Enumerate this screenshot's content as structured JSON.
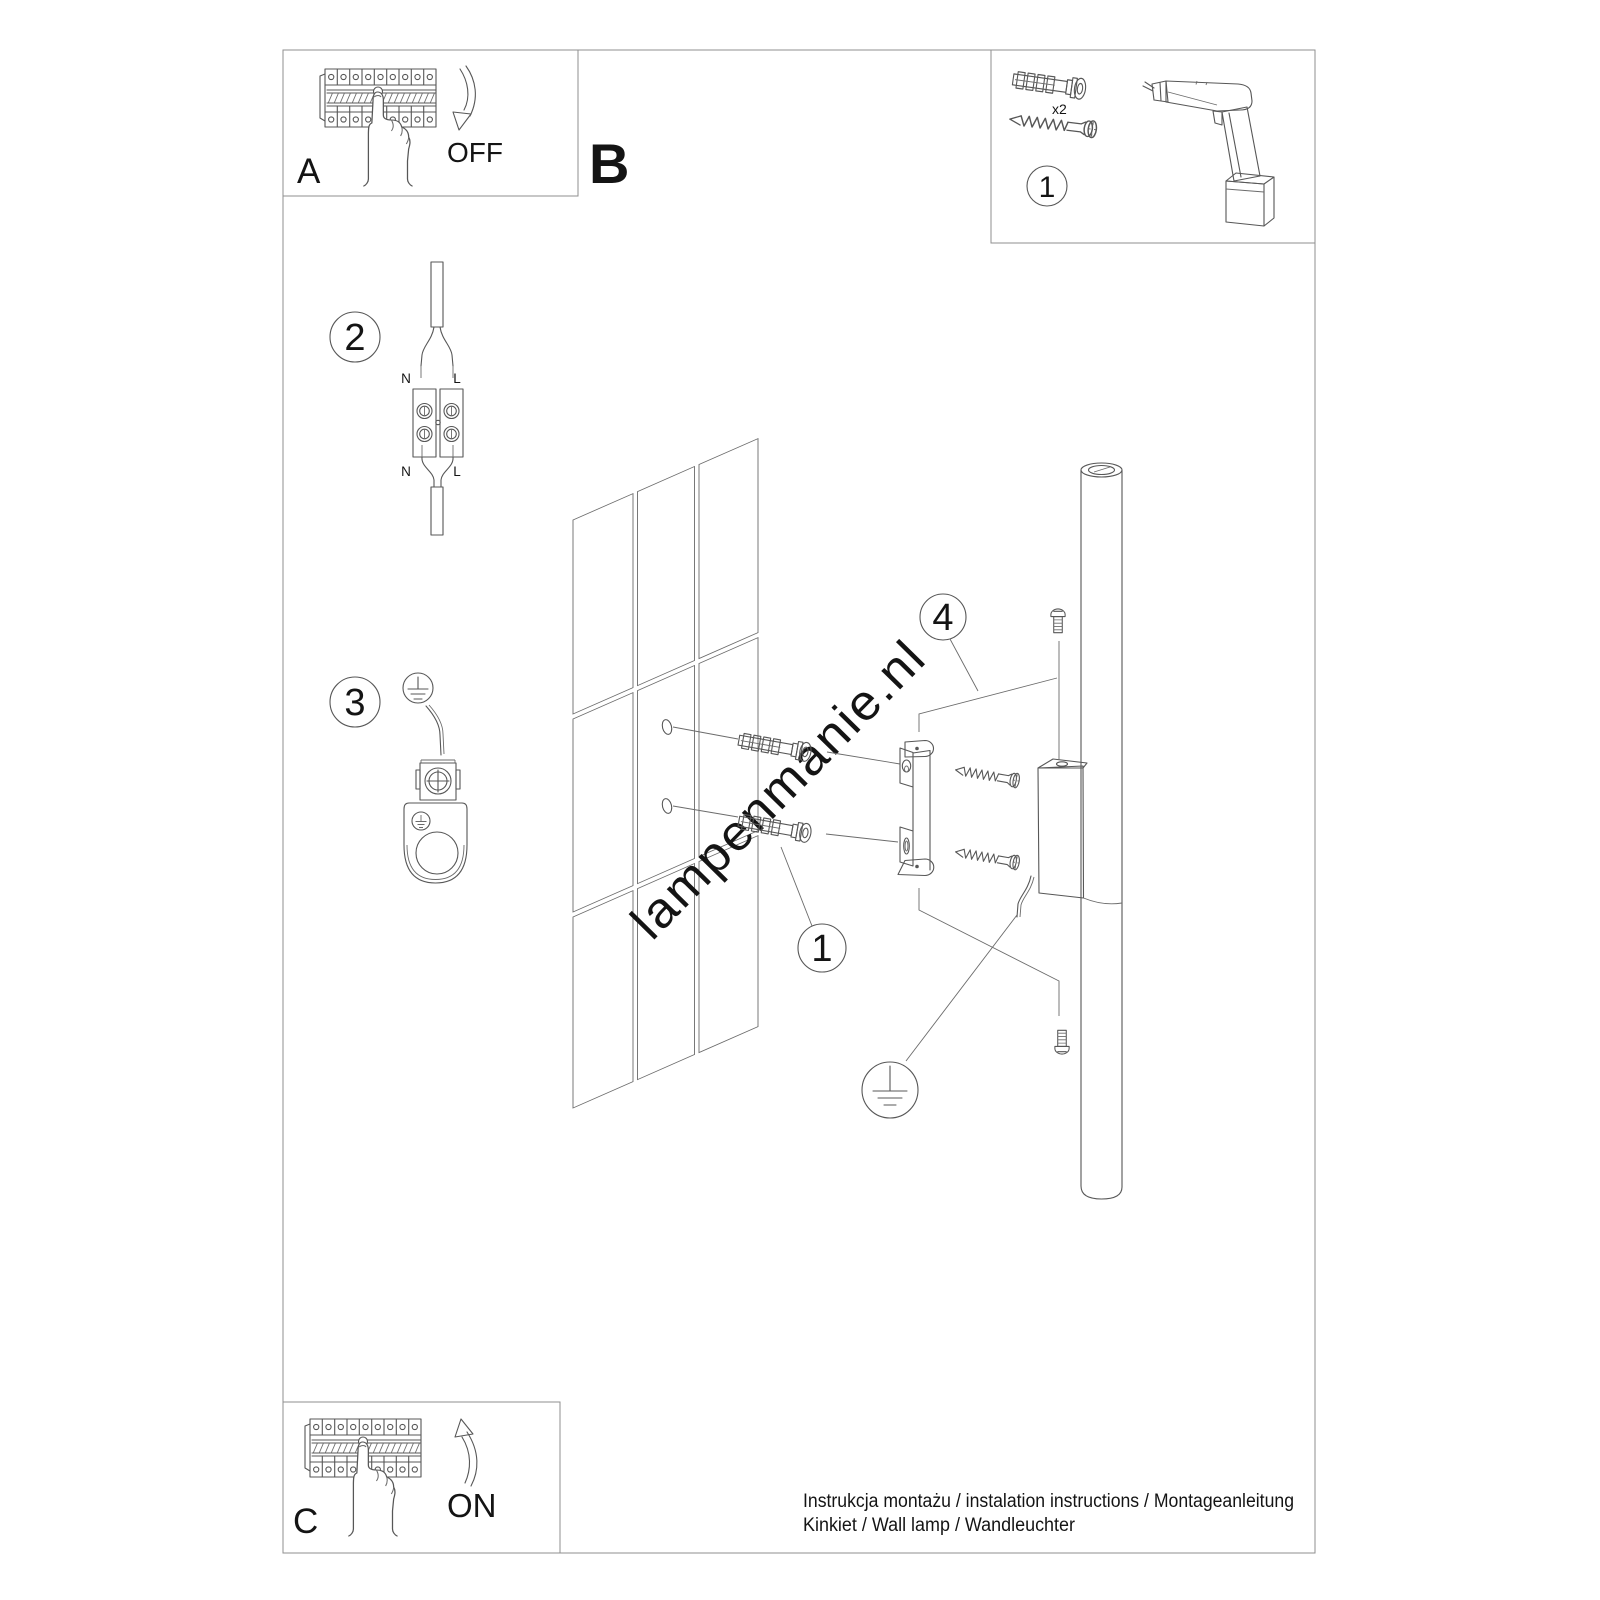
{
  "panel_a": {
    "label": "A",
    "action": "OFF"
  },
  "label_b": "B",
  "panel_c": {
    "label": "C",
    "action": "ON"
  },
  "tools_panel": {
    "callout": "1",
    "anchor_quantity": "x2"
  },
  "step2": {
    "callout": "2",
    "wire_labels": {
      "top_left": "N",
      "top_right": "L",
      "bottom_left": "N",
      "bottom_right": "L"
    }
  },
  "step3": {
    "callout": "3"
  },
  "assembly": {
    "anchor_callout": "1",
    "bracket_callout": "4"
  },
  "watermark": "lampenmanie.nl",
  "footer": {
    "line1": "Instrukcja montażu / instalation instructions / Montageanleitung",
    "line2": "Kinkiet / Wall lamp / Wandleuchter"
  },
  "colors": {
    "line_art": "#575757",
    "frame": "#8f8f8f",
    "text": "#141414",
    "watermark": "#d4d4d4"
  }
}
